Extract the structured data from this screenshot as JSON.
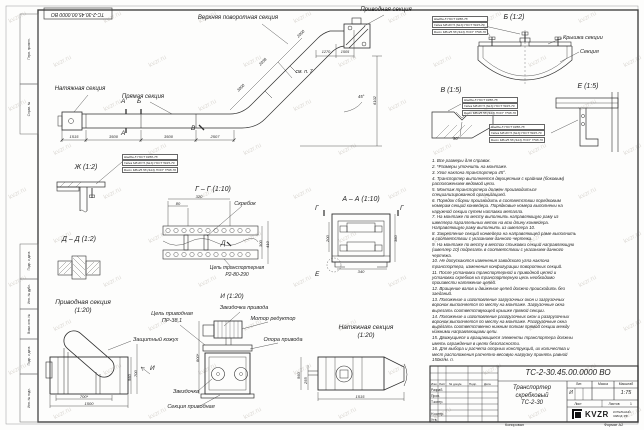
{
  "doc": {
    "number": "ТС-2-30.45.00.0000 ВО",
    "name1": "Транспортер",
    "name2": "скребковый",
    "name3": "ТС-2-30"
  },
  "views": {
    "b_title": "Б (1:2)",
    "v_title": "В (1:5)",
    "e_title": "Е (1:5)",
    "zh_title": "Ж (1:2)",
    "gg_title": "Г – Г (1:10)",
    "aa_title": "А – А (1:10)",
    "dd_title": "Д – Д (1:2)",
    "drive_title": "Приводная секция",
    "drive_scale": "(1:20)",
    "i_title": "И (1:20)",
    "tension_title": "Натяжная секция",
    "tension_scale": "(1:20)"
  },
  "labels": {
    "upper_turn": "Верхняя поворотная секция",
    "drive_section": "Приводная секция",
    "tension_section": "Натяжная секция",
    "straight_section": "Прямая секция",
    "see_p7": "см. п. 7",
    "cover": "Крышка секции",
    "section": "Секция",
    "scraper": "Скребок",
    "chain1": "Цепь транспортерная",
    "chain2": "Р2-80-290",
    "drive_chain1": "Цепь приводная",
    "drive_chain2": "ПР-38,1",
    "drive_sprocket": "Звездочка привода",
    "motor": "Мотор редуктор",
    "guard": "Защитный кожух",
    "support": "Опора привода",
    "sprocket": "Звездочка",
    "drive_sec": "Секция приводная"
  },
  "cuts": {
    "a": "А",
    "b": "Б",
    "v": "В",
    "g": "Г",
    "d": "Д",
    "e": "Е",
    "i": "И"
  },
  "callout": [
    "Шайба 8 ГОСТ 6958-78",
    "Гайка М8-6Н.5 (S13) ГОСТ 5915-70",
    "Болт М8х25.58 (S13) ГОСТ 7798-70"
  ],
  "dims": {
    "run1": "1515",
    "run2": "3500",
    "run3": "3500",
    "run4": "2507",
    "incline1": "3000",
    "incline2": "2038",
    "incline3": "2000",
    "top1": "1270",
    "top2": "1505",
    "height": "6102",
    "angle": "45°",
    "v_angle": "90°",
    "gg_w1": "320",
    "gg_w2": "80",
    "gg_h1": "300",
    "gg_h2": "410",
    "aa_h1": "200",
    "aa_h2": "380",
    "aa_w": "340",
    "drive_w1": "700*",
    "drive_w2": "1500",
    "drive_h1": "560",
    "drive_h2": "700",
    "i_h": "800*",
    "tens_h1": "560",
    "tens_h2": "255",
    "tens_w": "1515"
  },
  "notes": [
    "1. Все размеры для справок.",
    "2. *Размеры уточнить на монтаже.",
    "3. Угол наклона транспортера 45°.",
    "4. Транспортер выполняется двухцепным с крайним (боковым) расположением ведомой цепи.",
    "5. Монтаж транспортера должен производиться специализированной организацией.",
    "6. Порядок сборки производить в соответствии порядковым номерам секций конвейера. Порядковые номера выполнены на наружной секции путем наплавки металла.",
    "7. На монтаже по месту выполнить направляющую раму из швеллера параллельных веток на всю длину конвейера. Направляющую раму выполнить из швеллера 10.",
    "8. Закрепление секций конвейера на направляющей раме выполнить в соответствии с указанием данного чертежа.",
    "9. На монтаже по месту в местах стыковки секций направляющую (швеллер 10) подрезать в соответствии с указанием данного чертежа.",
    "10. Не допускаются изменения заводского угла наклона транспортера, изменения конфигурации поворотных секций.",
    "11. После установки транспортерной и приводной цепей и установки скребков на транспортерную цепь необходимо произвести натяжение цепей.",
    "12. Вращение валов и движение цепей должно происходить без заеданий.",
    "13. Положение и изготовление загрузочных окон и загрузочных воронок выполняется по месту на монтаже. Загрузочные окна вырезать соответствующей крышке прямой секции.",
    "14. Положение и изготовление разгрузочных окон и разгрузочных воронок выполняется по месту на монтаже. Разгрузочные окна вырезать соответственно нижним полкам прямой секции между нижними направляющими цепи.",
    "15. Движущиеся и вращающиеся элементы транспортера должны иметь ограждения в целях безопасности.",
    "16. Для выбора и расчета опорных конструкций, их количества и мест расположения расчетно-весовую нагрузку принять равной 150кг/м. п."
  ],
  "stamp": {
    "col_izm": "Изм.",
    "col_list": "Лист",
    "col_doc": "№ докум.",
    "col_podp": "Подп.",
    "col_data": "Дата",
    "row_razrab": "Разраб.",
    "row_prov": "Пров.",
    "row_tkontr": "Т.контр.",
    "row_nkontr": "Н.контр.",
    "row_utv": "Утв.",
    "lit_h": "Лит.",
    "mass_h": "Масса",
    "scale_h": "Масштаб",
    "lit_v": "И",
    "scale_v": "1:75",
    "sheet_h": "Лист",
    "sheets_h": "Листов",
    "sheets_v": "1",
    "kopiroval": "Копировал",
    "format": "Формат А2"
  },
  "logo": {
    "brand": "KVZR",
    "sub1": "КОТЕЛЬНЫЙ",
    "sub2": "ЗАВОД .РФ"
  },
  "side_strip": [
    "Перв. примен.",
    "Справ. №",
    "Подп. и дата",
    "Инв. № дубл.",
    "Взам. инв. №",
    "Подп. и дата",
    "Инв. № подл."
  ],
  "watermark": "kvzr.ru",
  "colors": {
    "ink": "#2f2f2f",
    "paper": "#fdfdfc",
    "watermark": "#968c7d"
  }
}
